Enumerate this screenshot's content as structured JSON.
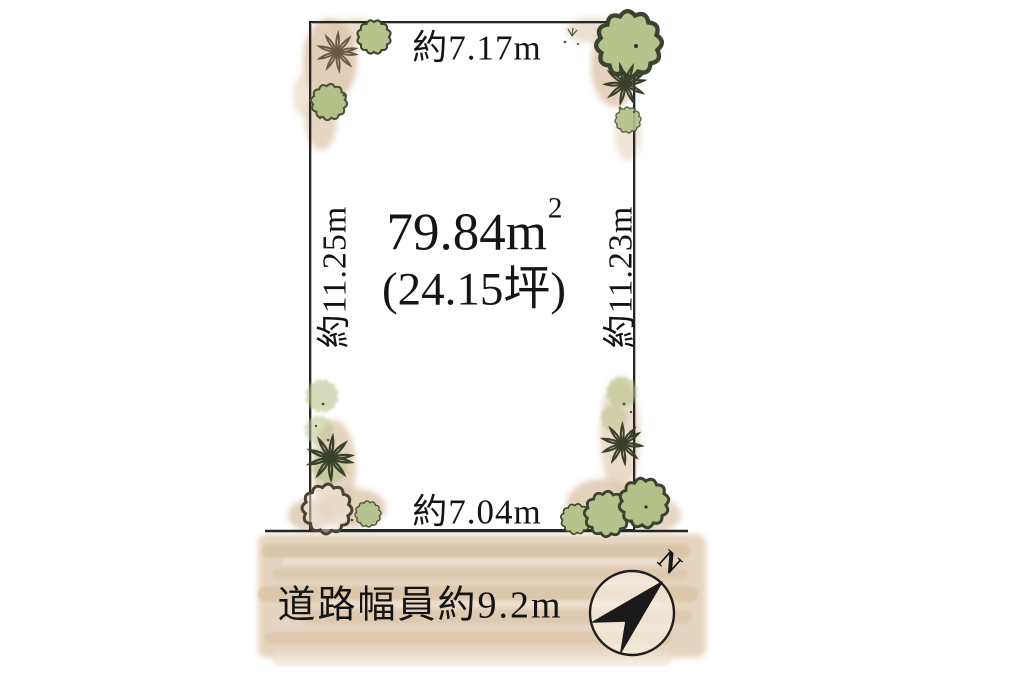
{
  "plot": {
    "top_dimension": "約7.17m",
    "bottom_dimension": "約7.04m",
    "left_dimension": "約11.25m",
    "right_dimension": "約11.23m",
    "area_value": "79.84m",
    "area_superscript": "2",
    "area_tsubo": "(24.15坪)"
  },
  "road": {
    "width_label": "道路幅員約9.2m"
  },
  "compass": {
    "north_label": "N"
  },
  "colors": {
    "line": "#262626",
    "text": "#141414",
    "watercolor_tan": "#dcc6aa",
    "watercolor_tan_light": "#ecdfcc",
    "watercolor_green": "#b6c38c",
    "watercolor_green_dark": "#93a561",
    "plant_outline": "#41462f",
    "star_plant_brown": "#6b5744",
    "compass_fill": "#1a1a1a"
  }
}
